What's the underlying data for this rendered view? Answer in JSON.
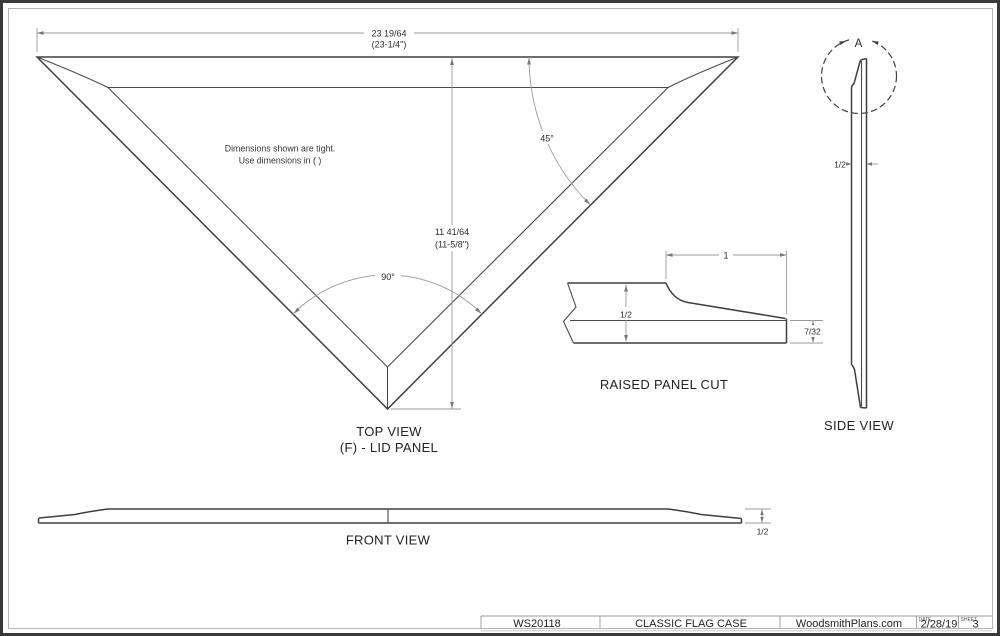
{
  "sheet": {
    "background": "#ffffff",
    "border_color": "#3a3a3a",
    "line_color": "#3f3f3f",
    "dim_color": "#9a9a9a",
    "text_color": "#2b2b2b"
  },
  "top_view": {
    "width_dim": "23 19/64",
    "width_dim_alt": "(23-1/4\")",
    "height_dim": "11 41/64",
    "height_dim_alt": "(11-5/8\")",
    "angle_corner": "45°",
    "angle_apex": "90°",
    "note_line1": "Dimensions shown are tight.",
    "note_line2": "Use dimensions in ( )",
    "label_line1": "TOP VIEW",
    "label_line2": "(F) - LID PANEL"
  },
  "raised_panel_cut": {
    "label": "RAISED PANEL CUT",
    "bevel_width_dim": "1",
    "thickness_dim": "1/2",
    "edge_thickness_dim": "7/32"
  },
  "side_view": {
    "label": "SIDE VIEW",
    "detail_marker": "A",
    "thickness_dim": "1/2"
  },
  "front_view": {
    "label": "FRONT VIEW",
    "thickness_dim": "1/2"
  },
  "title_block": {
    "plan_number": "WS20118",
    "drawing_title": "CLASSIC FLAG CASE",
    "publisher": "WoodsmithPlans.com",
    "date_label": "DATE",
    "date_value": "2/28/19",
    "sheet_label": "SHEET",
    "sheet_value": "3"
  }
}
